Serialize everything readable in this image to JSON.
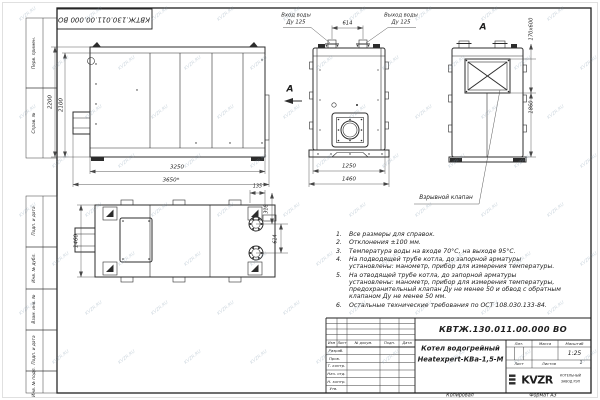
{
  "page": {
    "watermark_text": "KVZR.RU"
  },
  "frame": {
    "top_stamp": "КВТЖ.130.011.00.000 ВО",
    "side_labels": [
      "Перв. примен.",
      "Справ. №",
      "Подп. и дата",
      "Инв. № дубл.",
      "Взам. инв. №",
      "Подп. и дата",
      "Инв. № подл."
    ]
  },
  "views": {
    "side": {
      "h_outer": "2200",
      "h_inner": "2100",
      "w_inner": "3250",
      "w_outer": "3650*"
    },
    "front": {
      "inlet_line1": "Вход воды",
      "inlet_line2": "Ду 125",
      "outlet_line1": "Выход воды",
      "outlet_line2": "Ду 125",
      "pipes_dim": "614",
      "w_inner": "1250",
      "w_outer": "1460",
      "view_letter": "А"
    },
    "view_a": {
      "letter": "А",
      "valve_dim": "170х600",
      "height_dim": "1860",
      "valve_label": "Взрывной клапан"
    },
    "top": {
      "depth": "1460",
      "d135": "135",
      "d318": "318",
      "d614": "614"
    }
  },
  "notes": [
    {
      "n": "1.",
      "text": "Все размеры для справок."
    },
    {
      "n": "2.",
      "text": "Отклонения ±100 мм."
    },
    {
      "n": "3.",
      "text": "Температура воды на входе 70°С, на выходе 95°С."
    },
    {
      "n": "4.",
      "text": "На подводящей трубе котла, до запорной арматуры установлены: манометр, прибор для измерения температуры."
    },
    {
      "n": "5.",
      "text": "На отводящей трубе котла, до запорной арматуры установлены: манометр, прибор для измерения температуры, предохранительный клапан Ду не менее 50 и обвод с обратным клапаном Ду не менее 50 мм."
    },
    {
      "n": "6.",
      "text": "Остальные технические требования по ОСТ 108.030.133-84."
    }
  ],
  "title_block": {
    "doc_number": "КВТЖ.130.011.00.000 ВО",
    "name_line1": "Котел водогрейный",
    "name_line2": "Heatexpert-КВа-1,5-М",
    "col_izm": "Изм",
    "col_list": "Лист",
    "col_doc": "№ докум.",
    "col_podp": "Подп.",
    "col_data": "Дата",
    "rows": [
      "Разраб.",
      "Пров.",
      "Т. контр.",
      "Нач. отд.",
      "Н. контр.",
      "Утв."
    ],
    "lit_label": "Лит.",
    "mass_label": "Масса",
    "scale_label": "Масштаб",
    "scale_value": "1:25",
    "sheet_label": "Лист",
    "sheets_label": "Листов",
    "sheets_value": "1",
    "logo_text": "KVZR",
    "logo_sub1": "КОТЕЛЬНЫЙ",
    "logo_sub2": "ЗАВОД РЭП",
    "copied_label": "Копировал",
    "format_label": "Формат А3"
  }
}
